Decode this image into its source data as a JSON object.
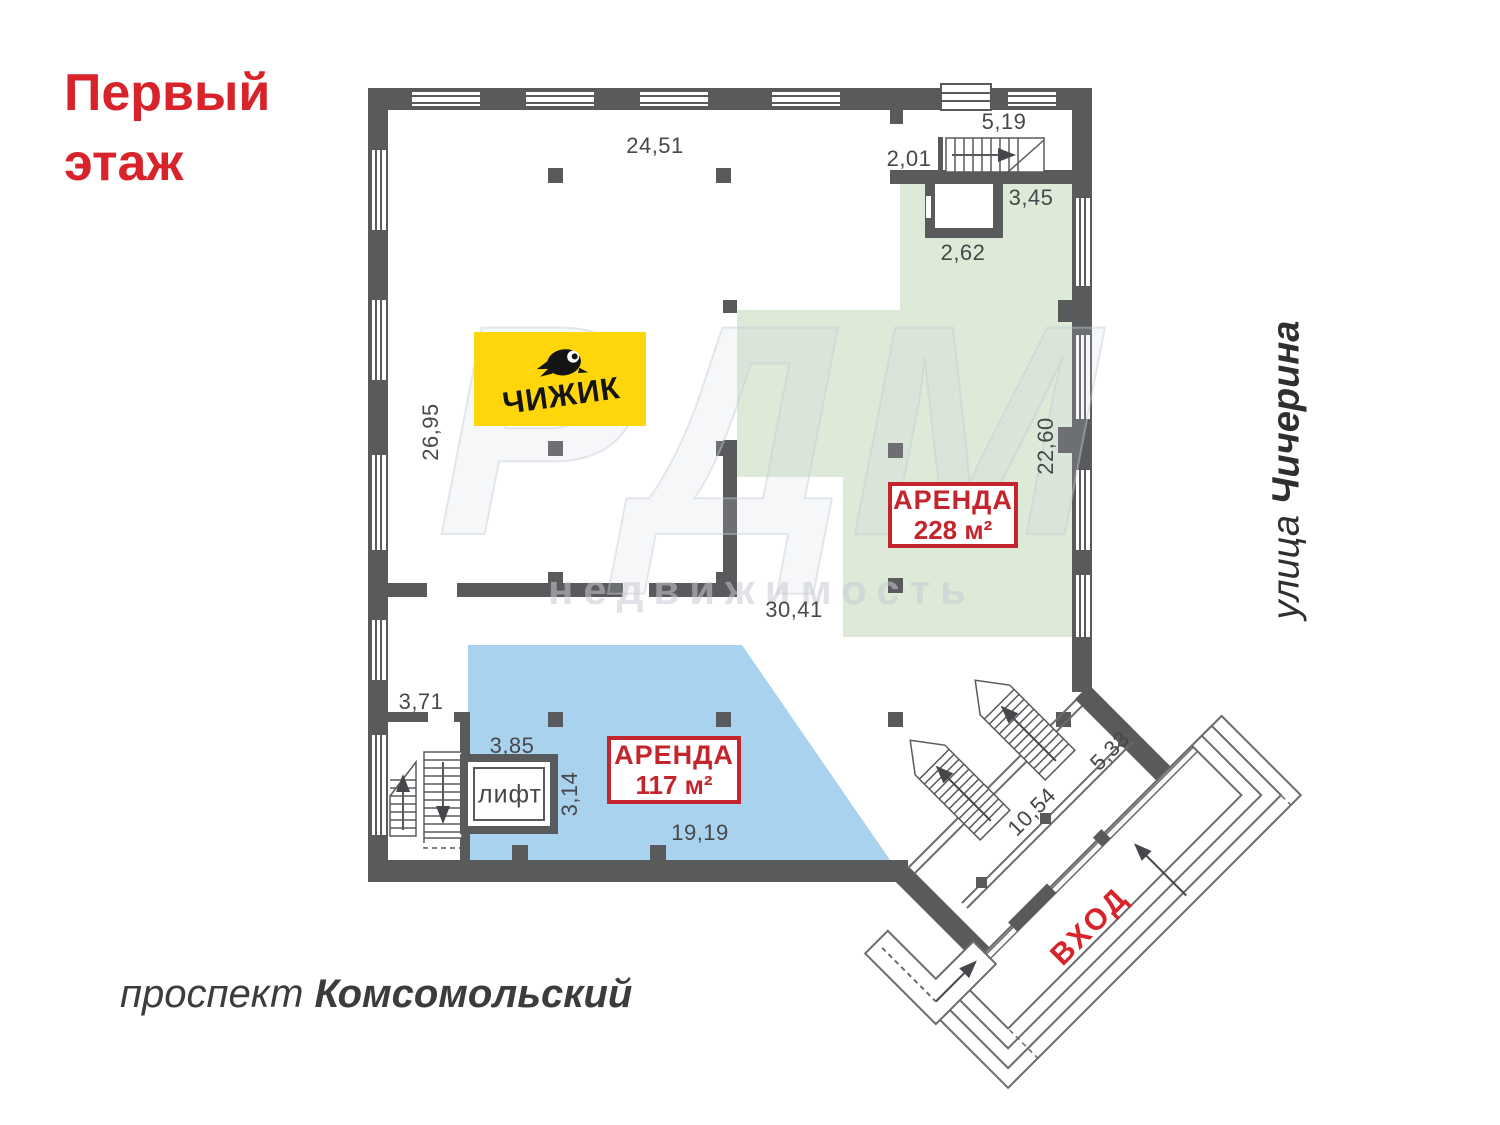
{
  "page_title": "Первый этаж",
  "title": {
    "line1": "Первый",
    "line2": "этаж"
  },
  "streets": {
    "bottom_prefix": "проспект ",
    "bottom_name": "Комсомольский",
    "right_prefix": "улица ",
    "right_name": "Чичерина"
  },
  "logo": {
    "name": "ЧИЖИК"
  },
  "rent_large": {
    "label": "АРЕНДА",
    "area": "228 м²"
  },
  "rent_small": {
    "label": "АРЕНДА",
    "area": "117 м²"
  },
  "entrance": {
    "label": "ВХОД"
  },
  "elevator": {
    "label": "лифт"
  },
  "watermark": {
    "line1": "РДМ",
    "line2": "недвижимость"
  },
  "dimensions": {
    "top_room_width": "24,51",
    "stair_room": "5,19",
    "passage": "2,01",
    "green_top": "3,45",
    "alcove": "2,62",
    "left_height": "26,95",
    "green_height": "22,60",
    "corridor_width": "30,41",
    "stair_width": "3,71",
    "lift_width": "3,85",
    "lift_depth": "3,14",
    "blue_width": "19,19",
    "entrance_length": "10,54",
    "entrance_width": "5,33"
  },
  "colors": {
    "wall": "#595a5c",
    "rent_green": "#dcead7",
    "rent_blue": "#a9d2ef",
    "accent_red": "#d8232b",
    "logo_yellow": "#ffd60a"
  }
}
